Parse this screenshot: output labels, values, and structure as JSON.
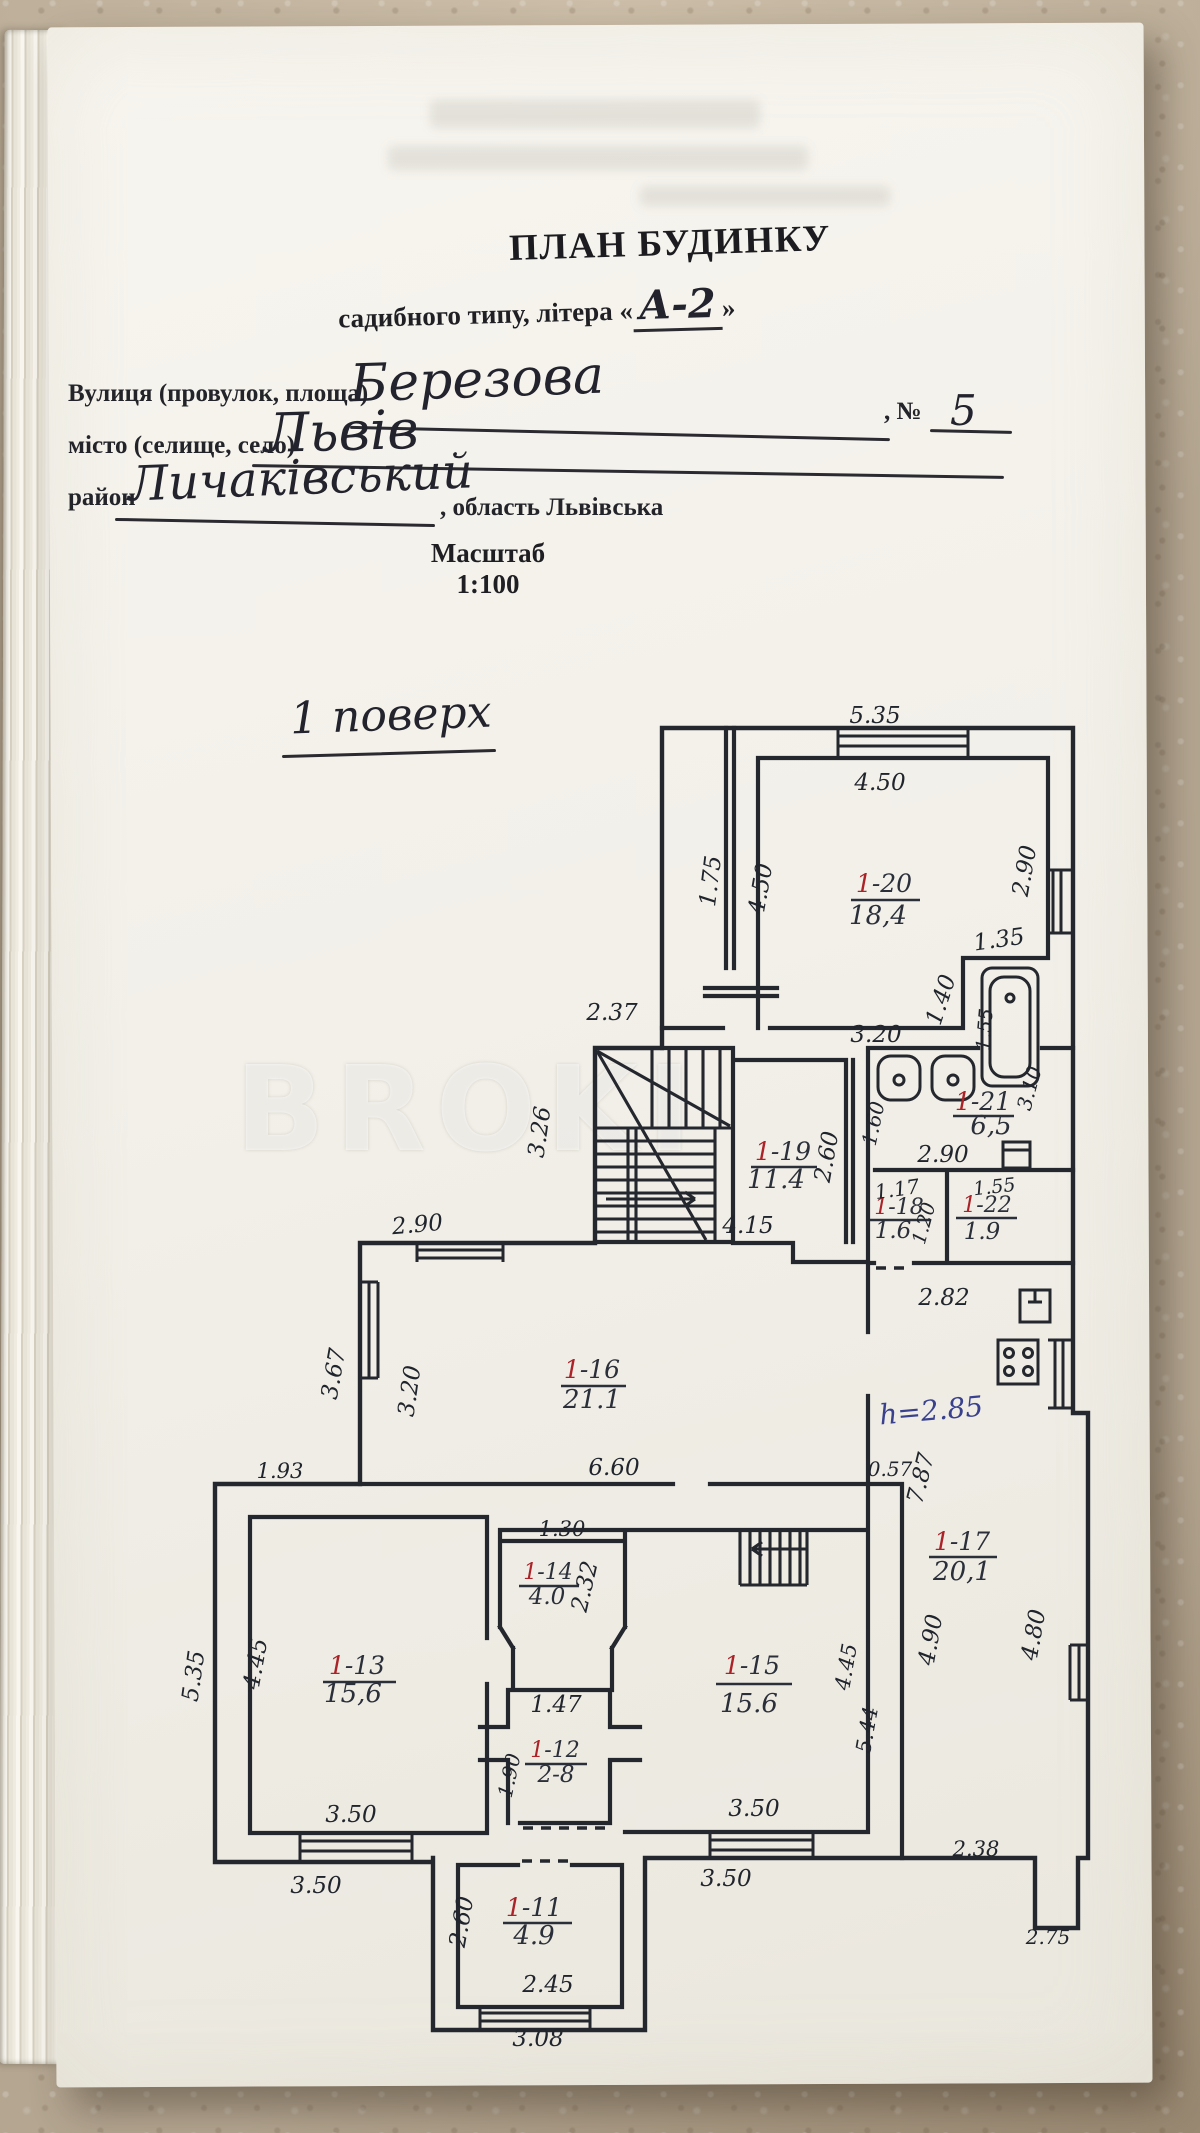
{
  "doc": {
    "title": "ПЛАН БУДИНКУ",
    "subtitle_prefix": "садибного типу, літера «",
    "letter": "А-2",
    "subtitle_suffix": "»",
    "street_label": "Вулиця (провулок, площа)",
    "street_value": "Березова",
    "no_label": ", №",
    "no_value": "5",
    "city_label": "місто (селище, село)",
    "city_value": "Львів",
    "district_label": "район",
    "district_value": "Личаківський",
    "oblast_label": ", область Львівська",
    "scale": "Масштаб 1:100",
    "floor": "1 поверх",
    "watermark": "BROKI"
  },
  "plan": {
    "height_note": "h=2.85",
    "rooms": [
      {
        "num_red": "1",
        "num_rest": "-20",
        "area": "18,4"
      },
      {
        "num_red": "1",
        "num_rest": "-21",
        "area": "6,5"
      },
      {
        "num_red": "1",
        "num_rest": "-19",
        "area": "11.4"
      },
      {
        "num_red": "1",
        "num_rest": "-18",
        "area": "1.6"
      },
      {
        "num_red": "1",
        "num_rest": "-22",
        "area": "1.9"
      },
      {
        "num_red": "1",
        "num_rest": "-16",
        "area": "21.1"
      },
      {
        "num_red": "1",
        "num_rest": "-17",
        "area": "20,1"
      },
      {
        "num_red": "1",
        "num_rest": "-14",
        "area": "4.0"
      },
      {
        "num_red": "1",
        "num_rest": "-13",
        "area": "15,6"
      },
      {
        "num_red": "1",
        "num_rest": "-15",
        "area": "15.6"
      },
      {
        "num_red": "1",
        "num_rest": "-12",
        "area": "2-8"
      },
      {
        "num_red": "1",
        "num_rest": "-11",
        "area": "4.9"
      }
    ],
    "dims": {
      "d1": "5.35",
      "d2": "4.50",
      "d3": "1.75",
      "d4": "4.50",
      "d5": "2.90",
      "d6": "1.35",
      "d7": "1.40",
      "d8": "1.55",
      "d9": "3.10",
      "d10": "3.20",
      "d11": "2.37",
      "d12": "3.26",
      "d13": "1.60",
      "d14": "2.90",
      "d15": "4.15",
      "d16": "2.60",
      "d17": "1.17",
      "d18": "1.20",
      "d19": "1.55",
      "d20": "2.90",
      "d21": "2.82",
      "d22": "3.67",
      "d23": "3.20",
      "d24": "6.60",
      "d25": "0.57",
      "d26": "7.87",
      "d27": "1.93",
      "d28": "1.30",
      "d29": "2.32",
      "d30": "5.35",
      "d31": "4.45",
      "d32": "1.47",
      "d33": "1.90",
      "d34": "4.90",
      "d35": "4.80",
      "d36": "4.45",
      "d37": "5.44",
      "d38": "3.50",
      "d39": "3.50",
      "d40": "2.38",
      "d41": "3.50",
      "d42": "3.50",
      "d43": "2.75",
      "d44": "2.60",
      "d45": "2.45",
      "d46": "3.08"
    }
  }
}
